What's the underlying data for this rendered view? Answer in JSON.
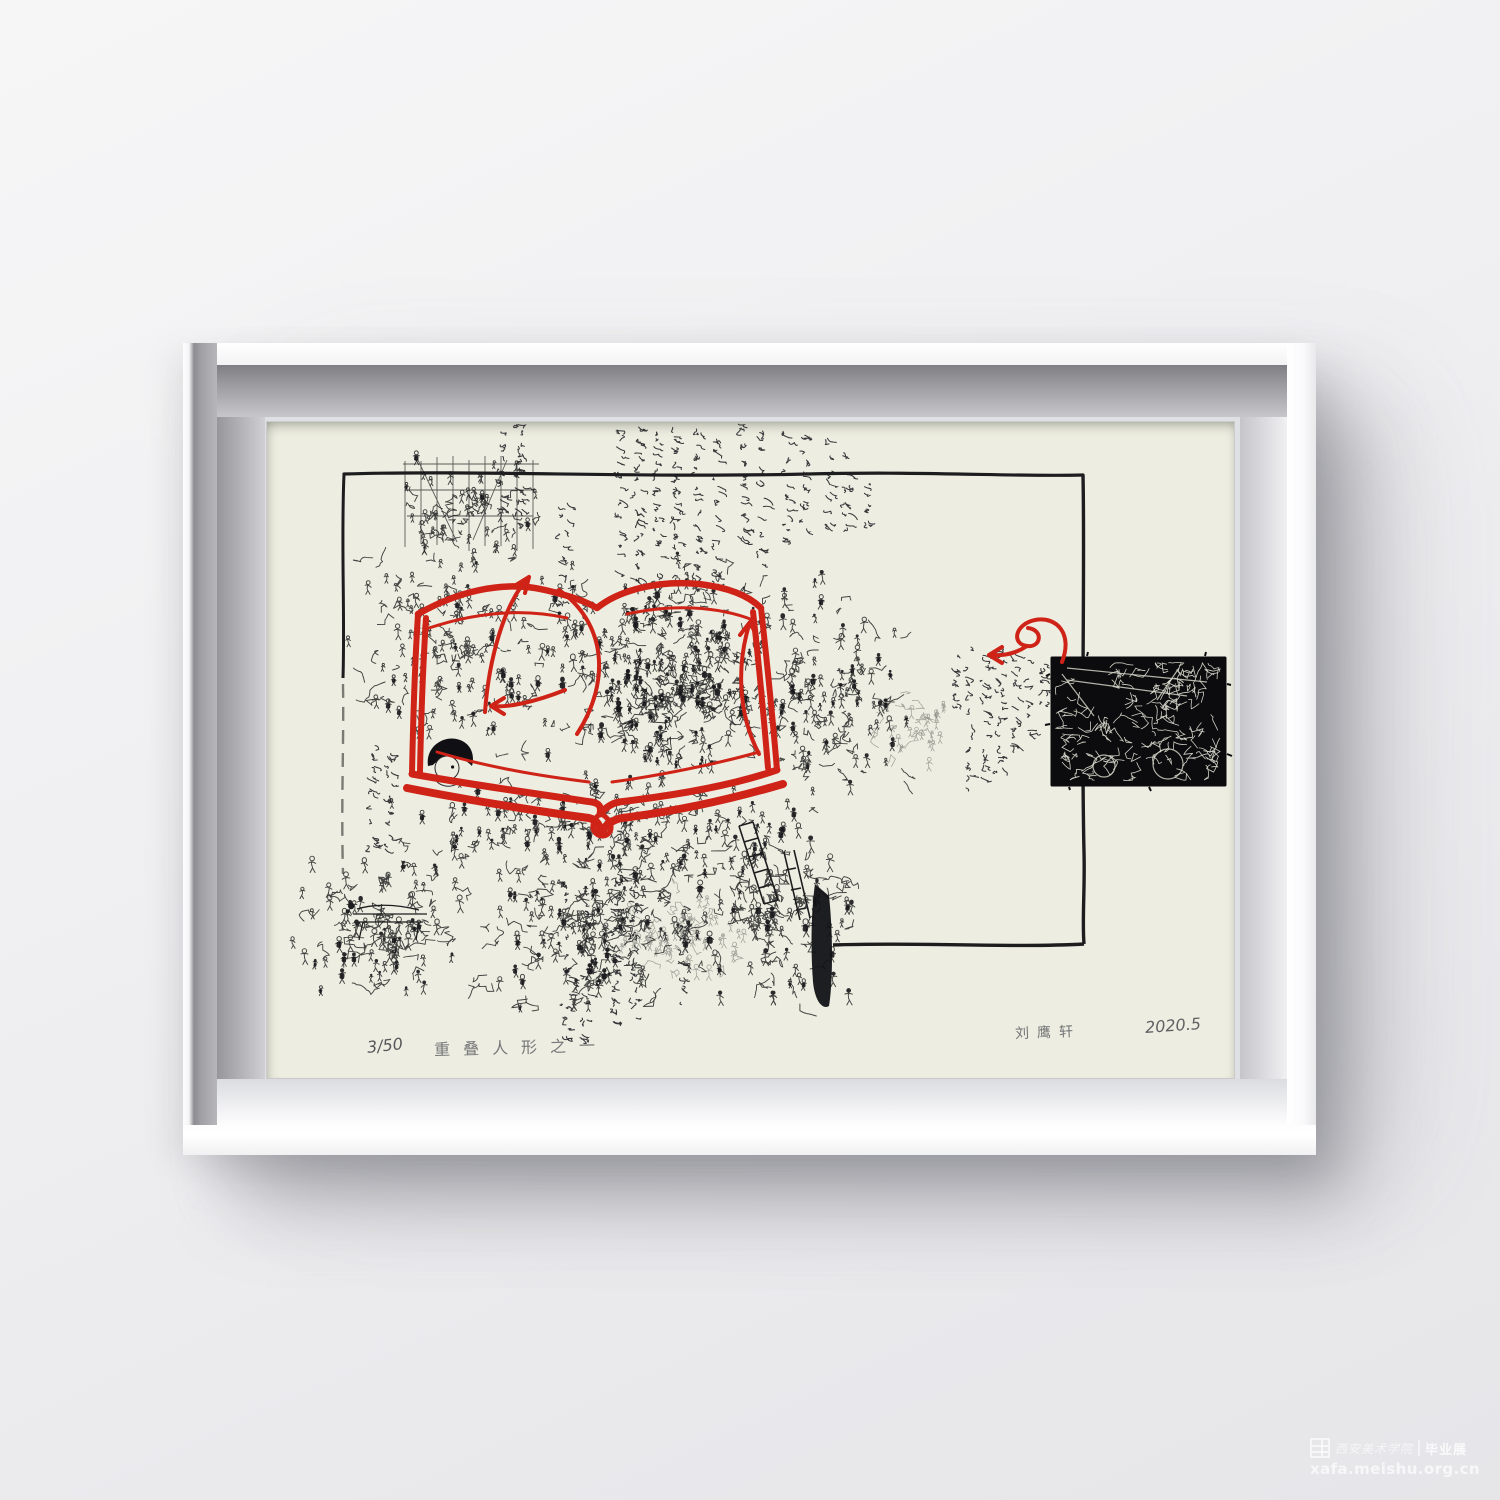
{
  "artwork": {
    "edition": "3/50",
    "title": "重叠人形之一",
    "signature": "刘鹰轩",
    "date": "2020.5"
  },
  "watermark": {
    "academy": "西安美术学院",
    "exhibition": "毕业展",
    "url": "xafa.meishu.org.cn"
  },
  "colors": {
    "accent_red": "#cf2318",
    "ink_black": "#1d1d1f",
    "paper_cream": "#edeee1",
    "wall_gray": "#eeeef0"
  }
}
